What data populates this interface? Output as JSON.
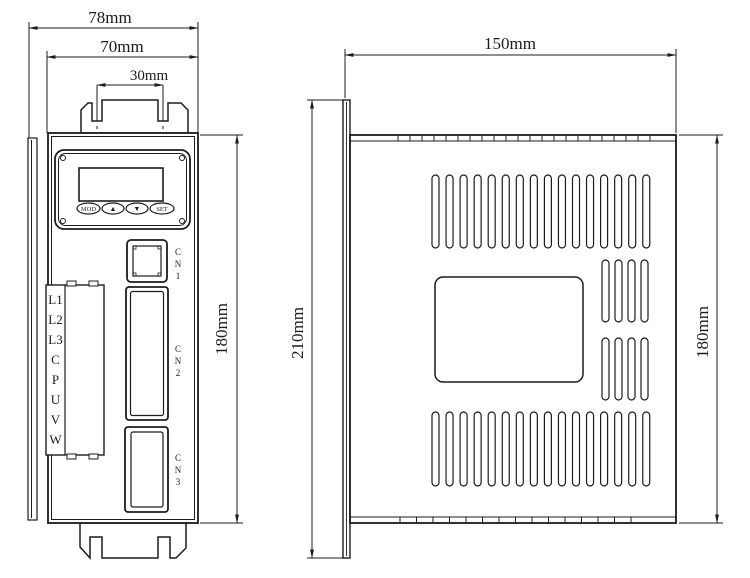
{
  "front_view": {
    "dim_width_outer": "78mm",
    "dim_width_body": "70mm",
    "dim_slot_spacing": "30mm",
    "dim_height": "180mm",
    "buttons": {
      "mode": "MOD",
      "up": "▲",
      "down": "▼",
      "set": "SET"
    },
    "terminals": [
      "L1",
      "L2",
      "L3",
      "C",
      "P",
      "U",
      "V",
      "W"
    ],
    "cn1": [
      "C",
      "N",
      "1"
    ],
    "cn2": [
      "C",
      "N",
      "2"
    ],
    "cn3": [
      "C",
      "N",
      "3"
    ]
  },
  "side_view": {
    "dim_depth": "150mm",
    "dim_height_flange": "210mm",
    "dim_height_body": "180mm"
  },
  "colors": {
    "line": "#1c1c1c",
    "background": "#ffffff"
  }
}
